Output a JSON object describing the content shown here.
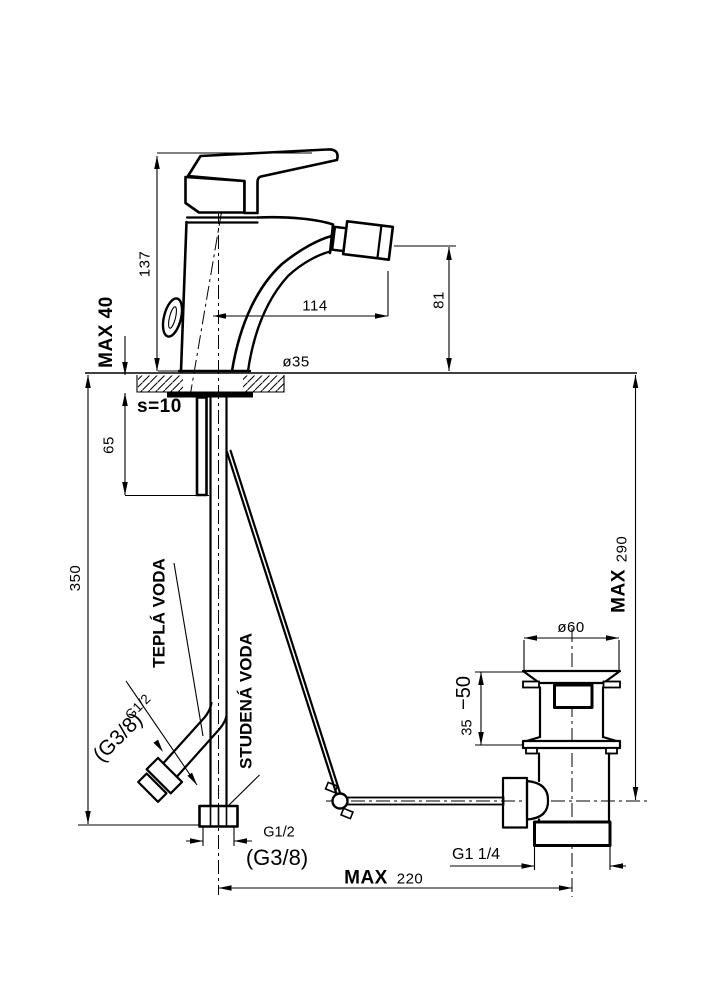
{
  "drawing": {
    "dimensions": {
      "body_height": "137",
      "max_deck": "MAX 40",
      "spout_reach": "114",
      "spout_height": "81",
      "hole_dia": "ø35",
      "plate_thickness": "s=10",
      "shank_length": "65",
      "hose_length": "350",
      "waste_max_label": "MAX",
      "waste_max_value": "290",
      "waste_dia": "ø60",
      "waste_clamp_max": "−50",
      "waste_clamp_min": "35",
      "waste_thread": "G1 1/4",
      "rod_max_label": "MAX",
      "rod_max_value": "220"
    },
    "connections": {
      "hot_label": "TEPLÁ VODA",
      "cold_label": "STUDENÁ VODA",
      "hot_thread": "G1/2",
      "hot_thread_alt": "(G3/8)",
      "cold_thread": "G1/2",
      "cold_thread_alt": "(G3/8)"
    }
  }
}
